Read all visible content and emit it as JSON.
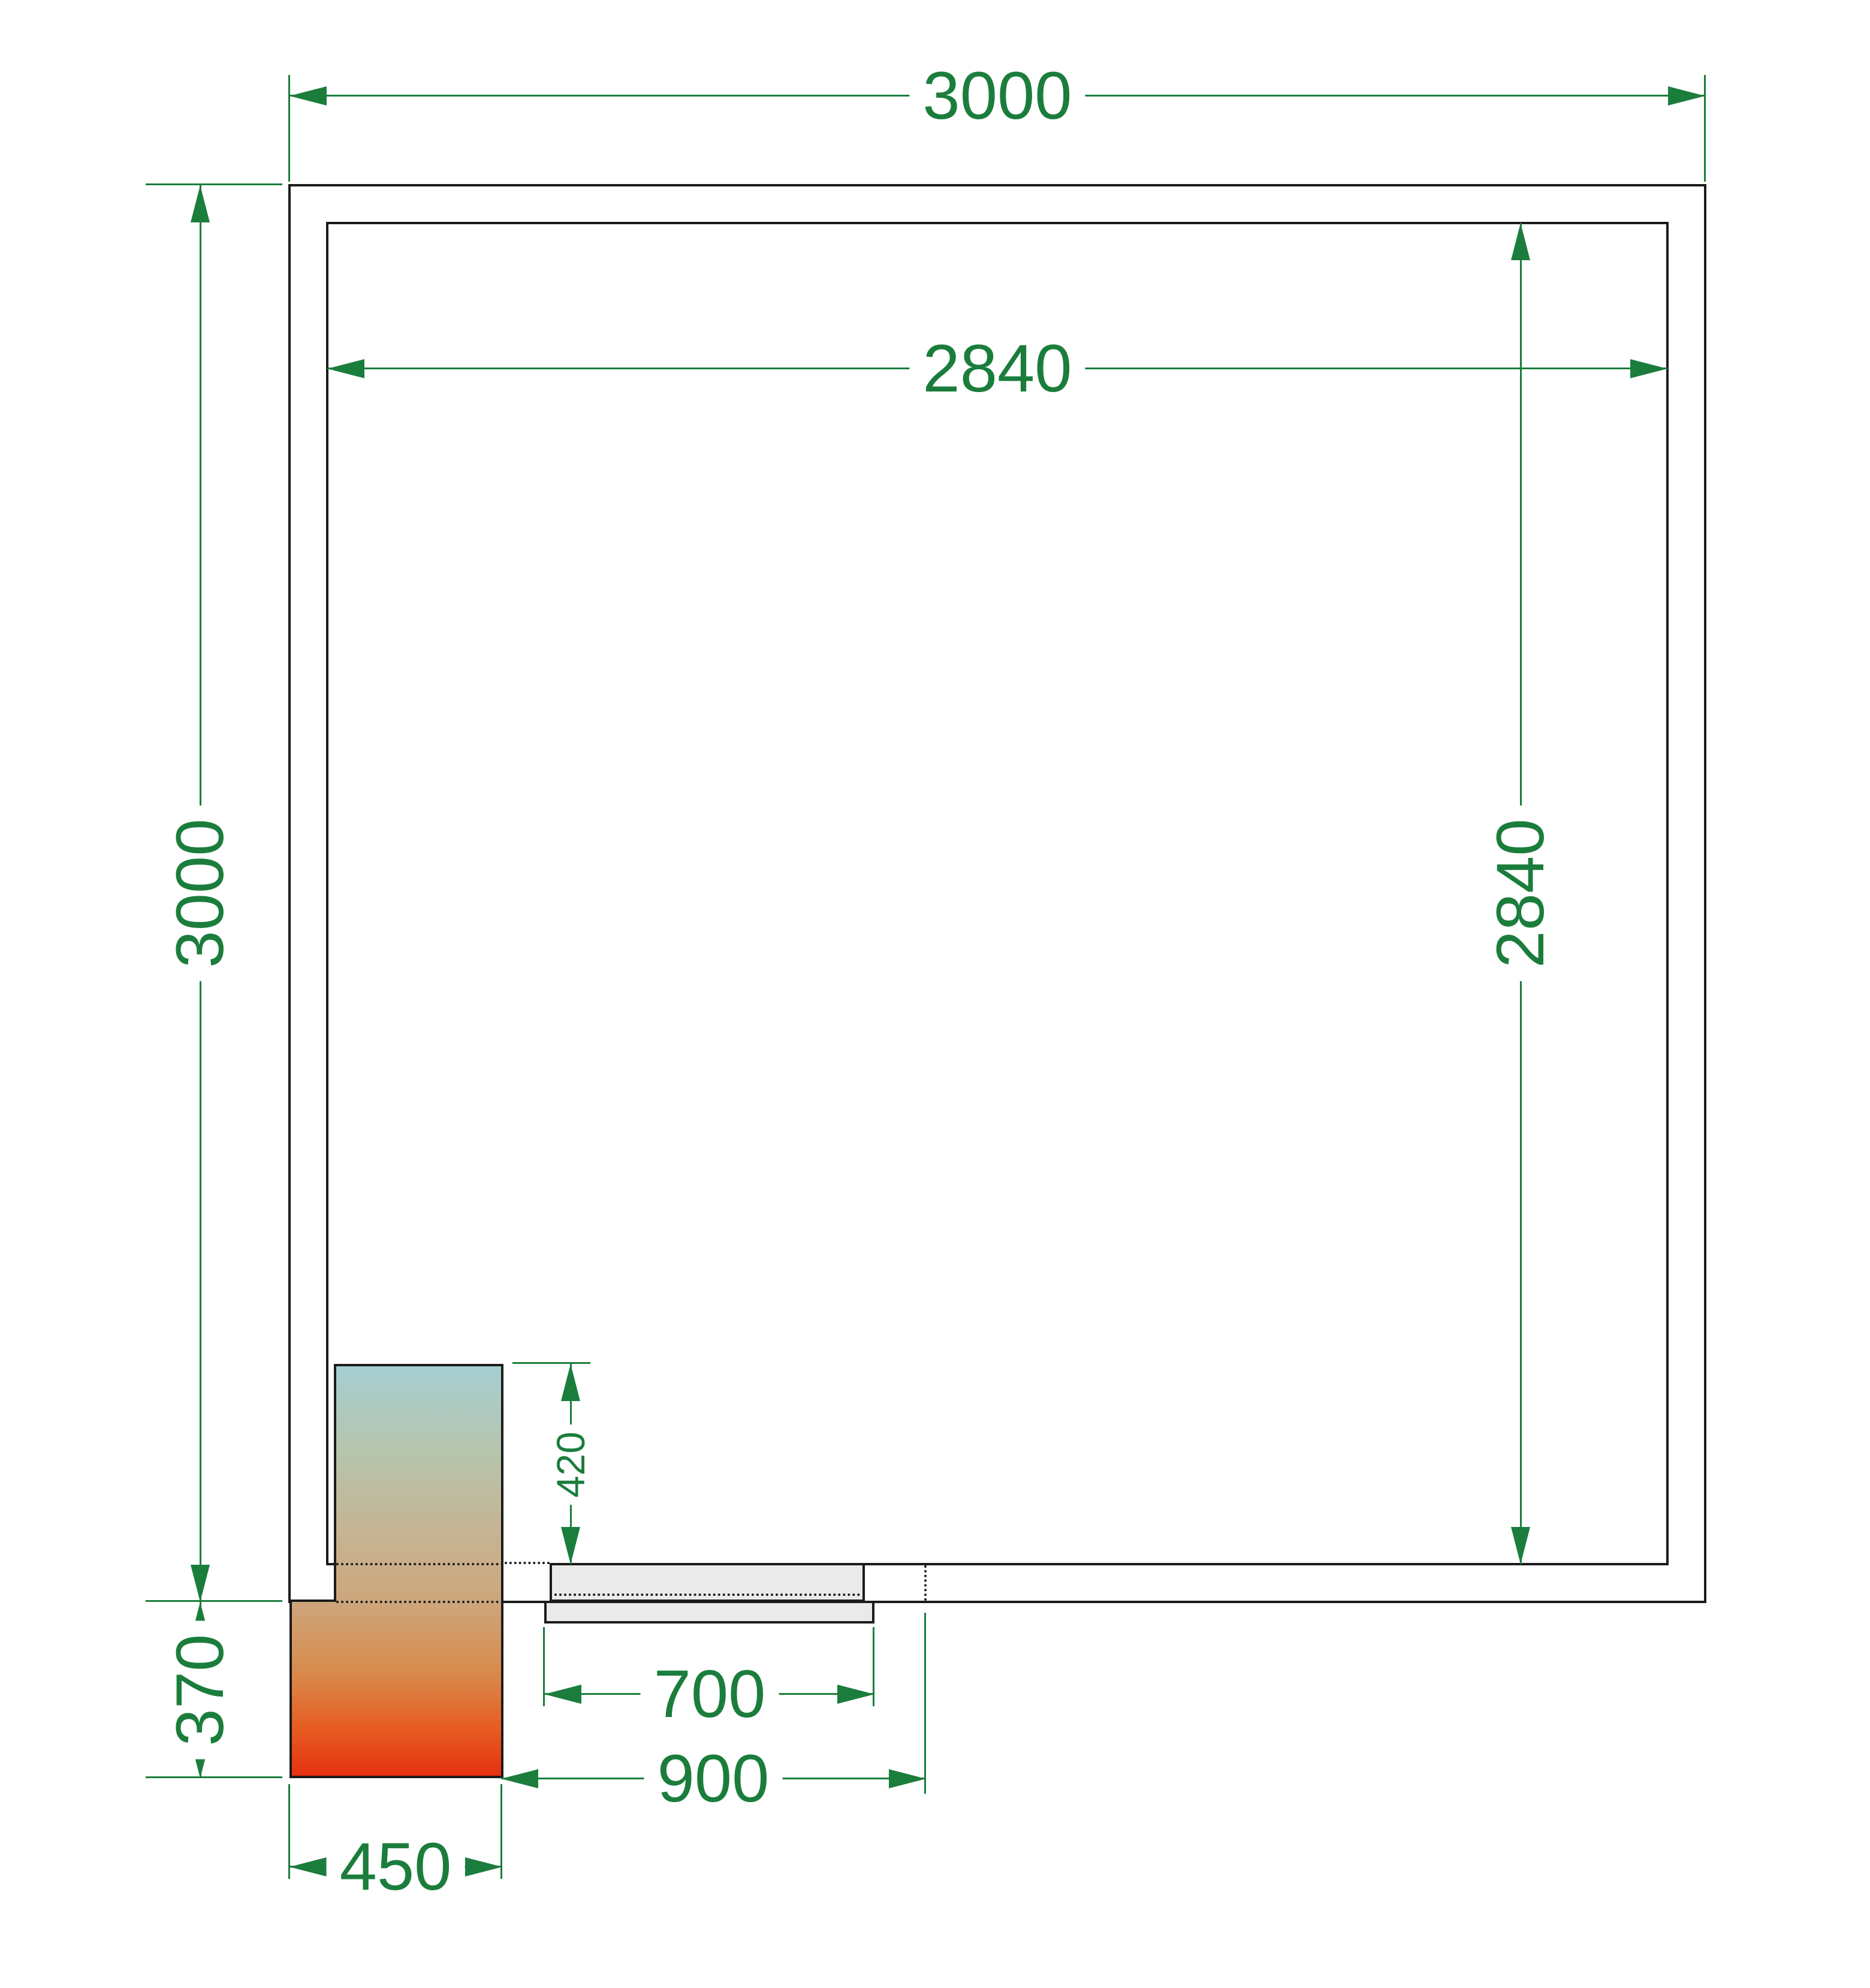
{
  "drawing": {
    "type": "cold-room floor plan, top view",
    "dims": {
      "outer_width": "3000",
      "outer_height": "3000",
      "inner_width": "2840",
      "inner_height": "2840",
      "unit_protrusion_inside": "420",
      "unit_protrusion_outside": "370",
      "unit_width": "450",
      "door_leaf_width": "700",
      "door_opening_width": "900"
    },
    "colors": {
      "dimension_green": "#1b7d3c",
      "wall_black": "#1b1b1b",
      "door_fill": "#eaeaea",
      "unit_gradient_top": "#a5ced2",
      "unit_gradient_middle": "#c6b493",
      "unit_gradient_bottom": "#e63111"
    }
  }
}
